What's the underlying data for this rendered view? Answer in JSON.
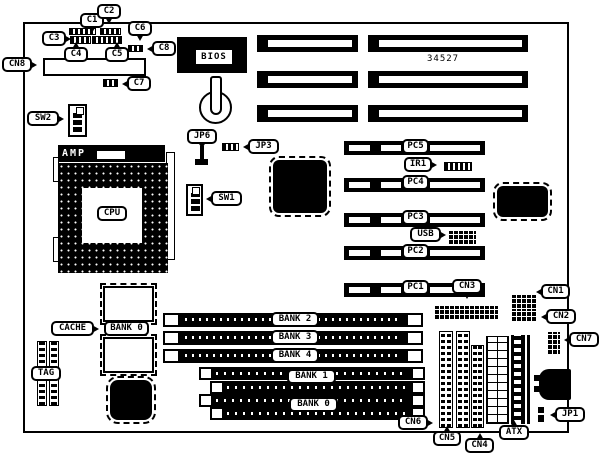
{
  "board": {
    "part_number": "34527"
  },
  "labels": {
    "c1": "C1",
    "c2": "C2",
    "c3": "C3",
    "c4": "C4",
    "c5": "C5",
    "c6": "C6",
    "c7": "C7",
    "c8": "C8",
    "cn1": "CN1",
    "cn2": "CN2",
    "cn3": "CN3",
    "cn4": "CN4",
    "cn5": "CN5",
    "cn6": "CN6",
    "cn7": "CN7",
    "cn8": "CN8",
    "sw1": "SW1",
    "sw2": "SW2",
    "jp1": "JP1",
    "jp3": "JP3",
    "jp6": "JP6",
    "ir1": "IR1",
    "usb": "USB",
    "atx": "ATX",
    "tag": "TAG",
    "cache": "CACHE",
    "cpu": "CPU",
    "amp": "AMP",
    "bios": "BIOS",
    "pc1": "PC1",
    "pc2": "PC2",
    "pc3": "PC3",
    "pc4": "PC4",
    "pc5": "PC5",
    "bank0_cache": "BANK 0",
    "bank0": "BANK 0",
    "bank1": "BANK 1",
    "bank2": "BANK 2",
    "bank3": "BANK 3",
    "bank4": "BANK 4"
  }
}
